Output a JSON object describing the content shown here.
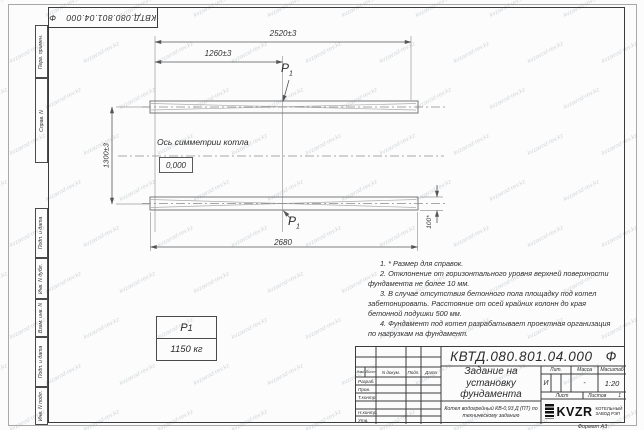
{
  "watermark": {
    "text": "kvzavod-rev.kz"
  },
  "designation": {
    "number": "КВТД.080.801.04.000",
    "suffix": "Ф"
  },
  "margin_boxes": [
    "Перв. примен.",
    "Справ. N",
    "Подп. и дата",
    "Инв. N дубл.",
    "Взам. инв. N",
    "Подп. и дата",
    "Инв. N подл."
  ],
  "drawing": {
    "dimensions": {
      "overall_width": "2520±3",
      "half_width": "1260±3",
      "height_between": "1300±3",
      "total_length": "2680",
      "pad_height": "100*"
    },
    "symmetry_axis_label": "Ось симметрии котла",
    "zero_elevation": "0,000",
    "load": {
      "symbol": "P",
      "subscript": "1",
      "value": "1150 кг"
    }
  },
  "notes": [
    "1. * Размер для справок.",
    "2. Отклонение от горизонтального уровня верхней поверхности фундамента не более 10 мм.",
    "3. В случае отсутствия бетонного пола площадку под котел забетонировать. Расстояние от осей крайних колонн до края бетонной подушки 500 мм.",
    "4. Фундамент под котел разрабатывает проектная организация по нагрузкам на фундамент."
  ],
  "title_block": {
    "title": "Задание на установку фундамента",
    "subtitle": "Котел водогрейный КВ-0,93 Д (ПТ) по техническому заданию",
    "header": {
      "izm": "Изм.",
      "list": "Лист",
      "doc": "N докум.",
      "sign": "Подп.",
      "date": "Дата"
    },
    "roles": {
      "developed": "Разраб.",
      "checked": "Пров.",
      "tcontrol": "Т.контр.",
      "ncontrol": "Н.контр.",
      "approved": "Утв."
    },
    "lit": {
      "label": "Лит.",
      "value": "И"
    },
    "mass": {
      "label": "Масса",
      "value": "-"
    },
    "scale": {
      "label": "Масштаб",
      "value": "1:20"
    },
    "sheet": {
      "label": "Лист",
      "of_label": "Листов",
      "of_value": "1"
    },
    "logo": {
      "text": "KVZR",
      "caption_line1": "КОТЕЛЬНЫЙ",
      "caption_line2": "ЗАВОД РЭП"
    },
    "format": "Формат А3"
  }
}
